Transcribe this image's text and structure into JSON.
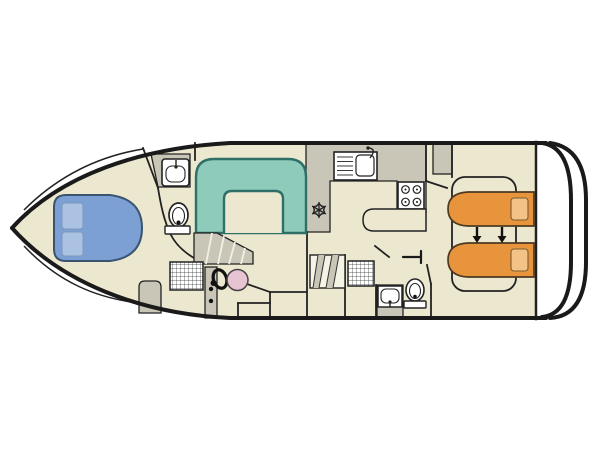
{
  "diagram": {
    "type": "houseboat-deck-plan",
    "orientation": "bow-left-stern-right",
    "rooms": [
      {
        "name": "front-cabin",
        "furniture": [
          "double-bed",
          "two-pillows"
        ]
      },
      {
        "name": "front-bathroom",
        "furniture": [
          "washbasin-on-counter",
          "toilet"
        ]
      },
      {
        "name": "saloon",
        "furniture": [
          "u-shaped-dinette",
          "winder-stairs"
        ]
      },
      {
        "name": "helm-station",
        "furniture": [
          "steering-wheel",
          "helm-seat",
          "bench",
          "entry-grating",
          "console"
        ]
      },
      {
        "name": "galley",
        "furniture": [
          "sink-with-drainer",
          "four-burner-hob",
          "fridge-snowflake",
          "counter-peninsula",
          "companionway-steps"
        ]
      },
      {
        "name": "aft-bathroom",
        "furniture": [
          "washbasin",
          "toilet",
          "entry-grating",
          "door"
        ]
      },
      {
        "name": "aft-cabin",
        "furniture": [
          "single-bed-port",
          "single-bed-starboard",
          "convertible-bed-arrows",
          "wardrobe",
          "bed-platform"
        ]
      },
      {
        "name": "stern-deck",
        "furniture": []
      }
    ],
    "bed_count": {
      "double": 1,
      "single": 2
    },
    "arrow_direction": "down"
  },
  "colors": {
    "page_bg": "#ffffff",
    "hull_line": "#1a1a1a",
    "wall": "#222222",
    "floor": "#ECE8D0",
    "cabinet_gray": "#C9C6B8",
    "step_light": "#F5F3E6",
    "dinette_fill": "#8FCBBA",
    "dinette_border": "#2E6F67",
    "front_bed_fill": "#7CA0D4",
    "front_bed_border": "#3A5470",
    "front_pillow": "#ABC2E3",
    "aft_bed_fill": "#E8943C",
    "aft_bed_border": "#4D3A20",
    "aft_pillow": "#F3C286",
    "helm_seat_fill": "#E8C4D2",
    "icon_white": "#FFFFFF"
  }
}
